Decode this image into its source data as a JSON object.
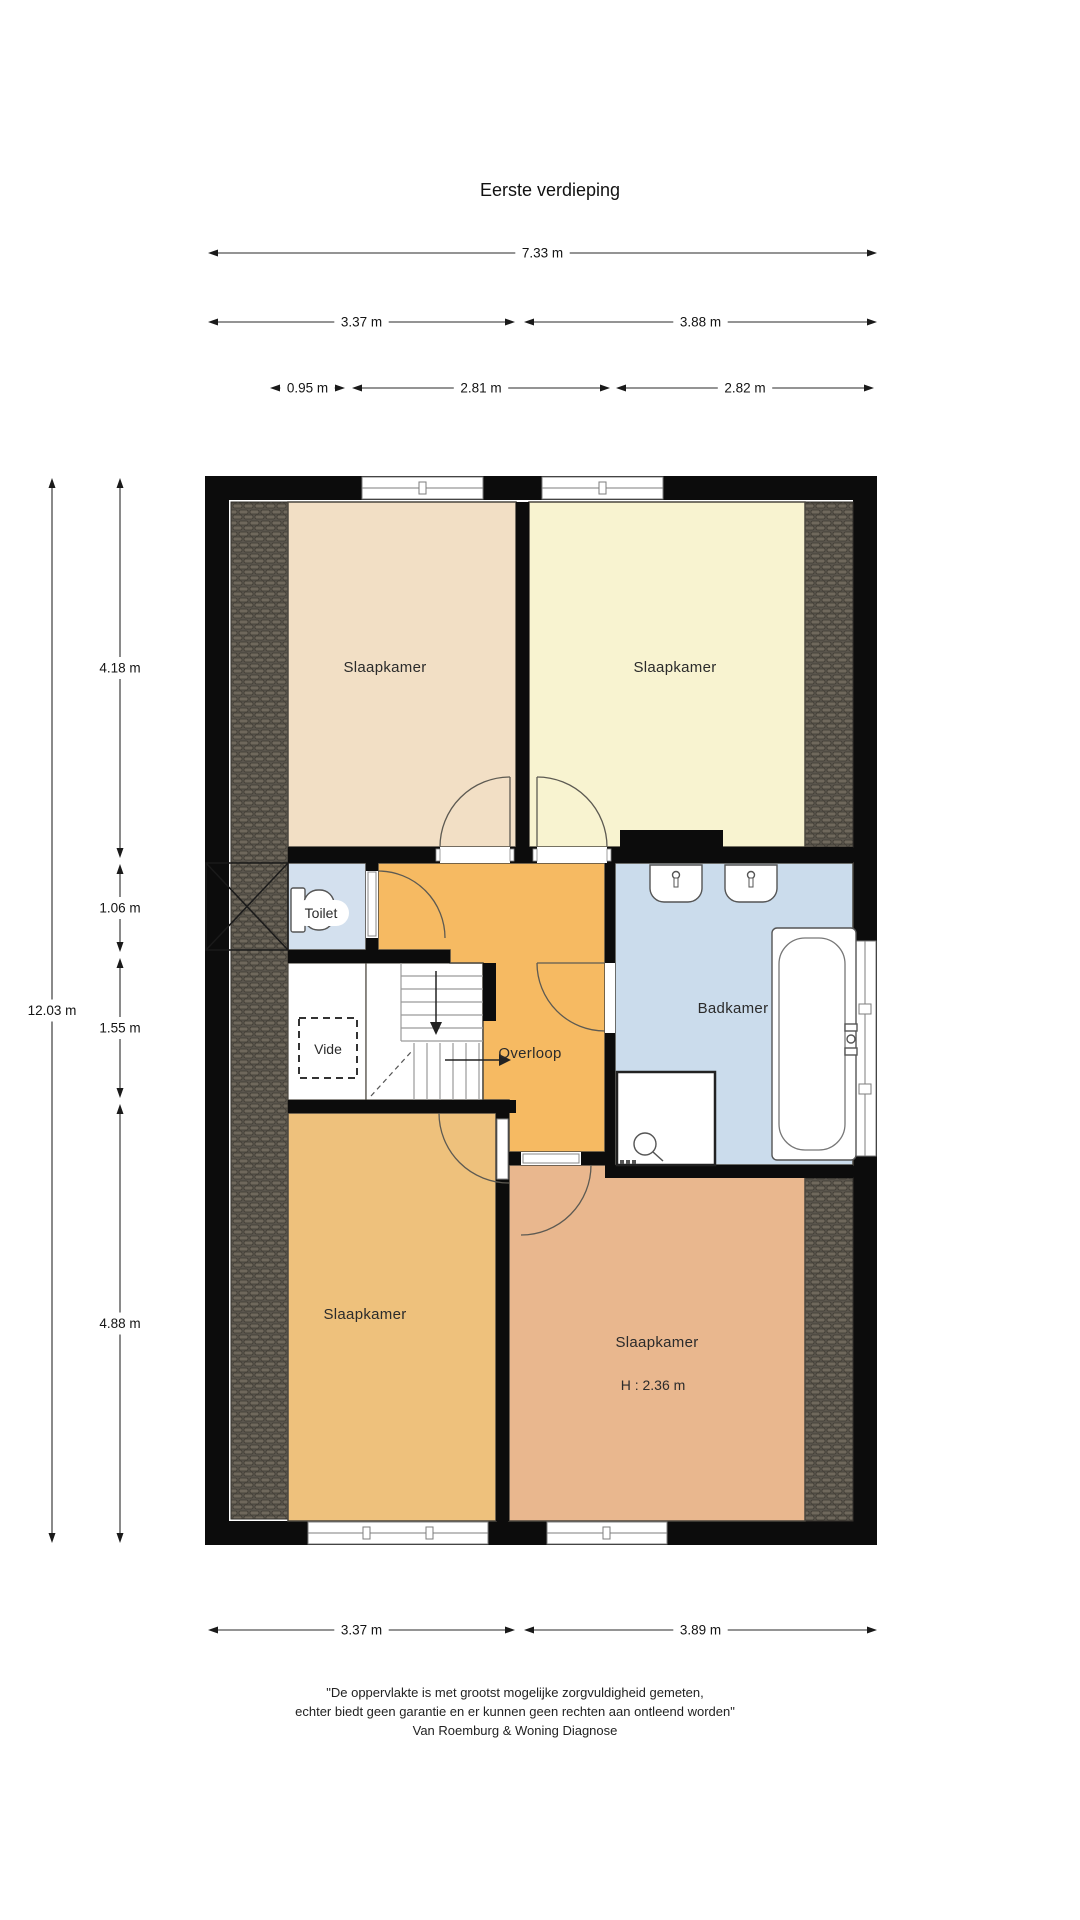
{
  "title": "Eerste verdieping",
  "rooms": {
    "bedroom_tl": "Slaapkamer",
    "bedroom_tr": "Slaapkamer",
    "bedroom_bl": "Slaapkamer",
    "bedroom_br": "Slaapkamer",
    "bedroom_br_height": "H : 2.36 m",
    "toilet": "Toilet",
    "vide": "Vide",
    "landing": "Overloop",
    "bathroom": "Badkamer"
  },
  "dimensions": {
    "top_total": "7.33 m",
    "top_left": "3.37 m",
    "top_right": "3.88 m",
    "top_sub1": "0.95 m",
    "top_sub2": "2.81 m",
    "top_sub3": "2.82 m",
    "left_total": "12.03 m",
    "left_seg1": "4.18 m",
    "left_seg2": "1.06 m",
    "left_seg3": "1.55 m",
    "left_seg4": "4.88 m",
    "right_seg1": "4.18 m",
    "right_seg2": "3.79 m",
    "right_seg3": "3.84 m",
    "right_outer1": "3.43 m",
    "right_outer2": "4.18 m",
    "bottom_left": "3.37 m",
    "bottom_right": "3.89 m"
  },
  "disclaimer": {
    "line1": "\"De oppervlakte is met grootst mogelijke zorgvuldigheid gemeten,",
    "line2": "echter biedt geen garantie en er kunnen geen rechten aan ontleend worden\"",
    "line3": "Van Roemburg & Woning Diagnose"
  },
  "colors": {
    "bedroom_tl": "#f2dfc5",
    "bedroom_tr": "#f8f3d0",
    "bedroom_bl": "#eec17c",
    "bedroom_br": "#e9b78e",
    "toilet": "#d3e0ee",
    "bathroom": "#cbdcec",
    "landing": "#f6ba62",
    "wall": "#0c0c0c",
    "roof_base": "#5b564d",
    "roof_brick": "#6f685c"
  }
}
